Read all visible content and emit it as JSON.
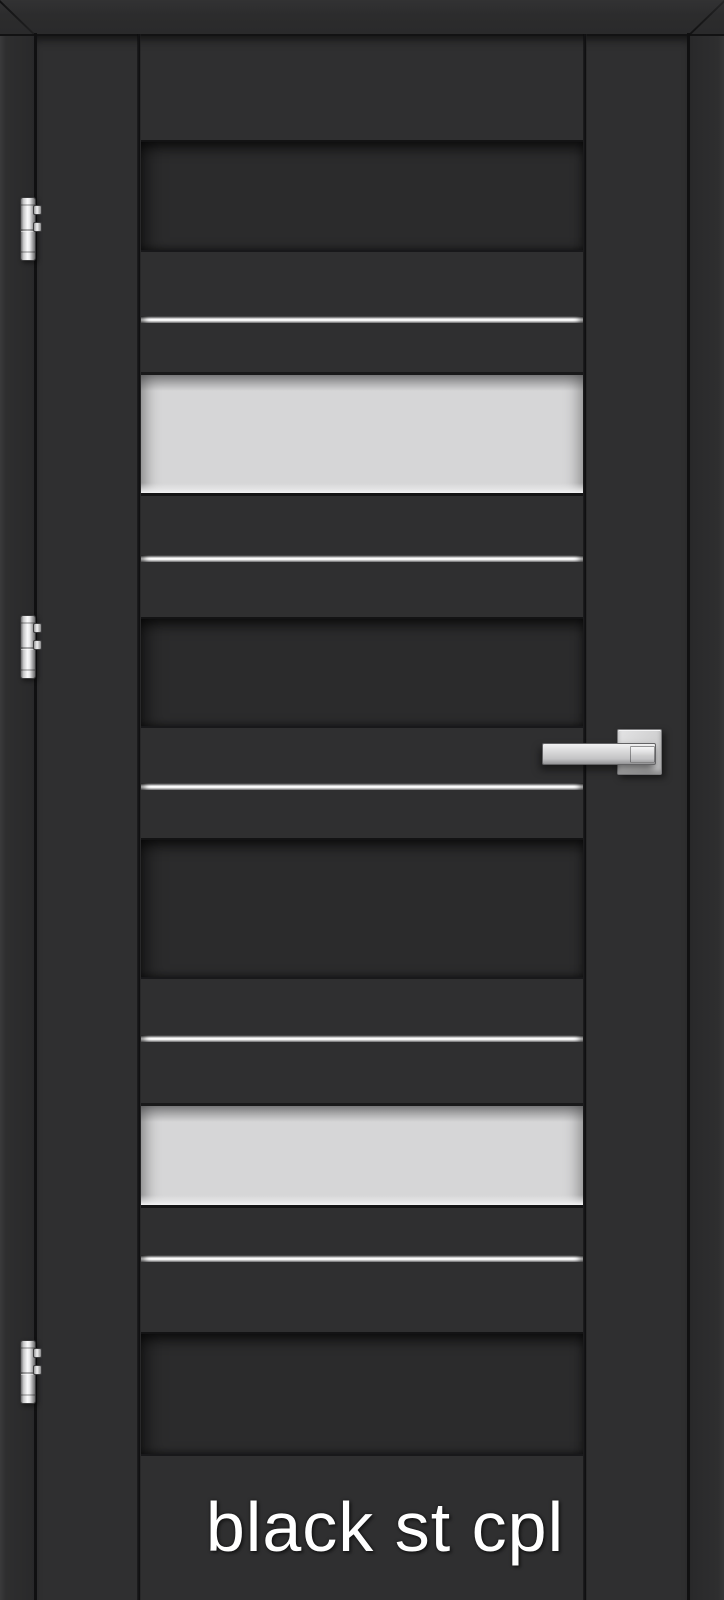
{
  "door": {
    "label": "black st cpl",
    "colors": {
      "frame": "#2b2b2c",
      "leaf": "#2f2f30",
      "recessed_panel": "#2b2b2c",
      "glass": "#d6d6d7",
      "aluminum_strip": "#fbfbfb",
      "hardware_metal": "#d4d4d5",
      "label_text": "#ffffff"
    },
    "bands": [
      {
        "type": "panel",
        "top": 140,
        "height": 108
      },
      {
        "type": "strip",
        "top": 316,
        "height": 7
      },
      {
        "type": "glass",
        "top": 372,
        "height": 118
      },
      {
        "type": "strip",
        "top": 555,
        "height": 7
      },
      {
        "type": "panel",
        "top": 617,
        "height": 107
      },
      {
        "type": "strip",
        "top": 783,
        "height": 7
      },
      {
        "type": "panel",
        "top": 838,
        "height": 137
      },
      {
        "type": "strip",
        "top": 1035,
        "height": 7
      },
      {
        "type": "glass",
        "top": 1103,
        "height": 99
      },
      {
        "type": "strip",
        "top": 1255,
        "height": 7
      },
      {
        "type": "panel",
        "top": 1332,
        "height": 120
      }
    ],
    "hinges": [
      {
        "position": "top",
        "top": 197
      },
      {
        "position": "middle",
        "top": 615
      },
      {
        "position": "bottom",
        "top": 1340
      }
    ]
  }
}
